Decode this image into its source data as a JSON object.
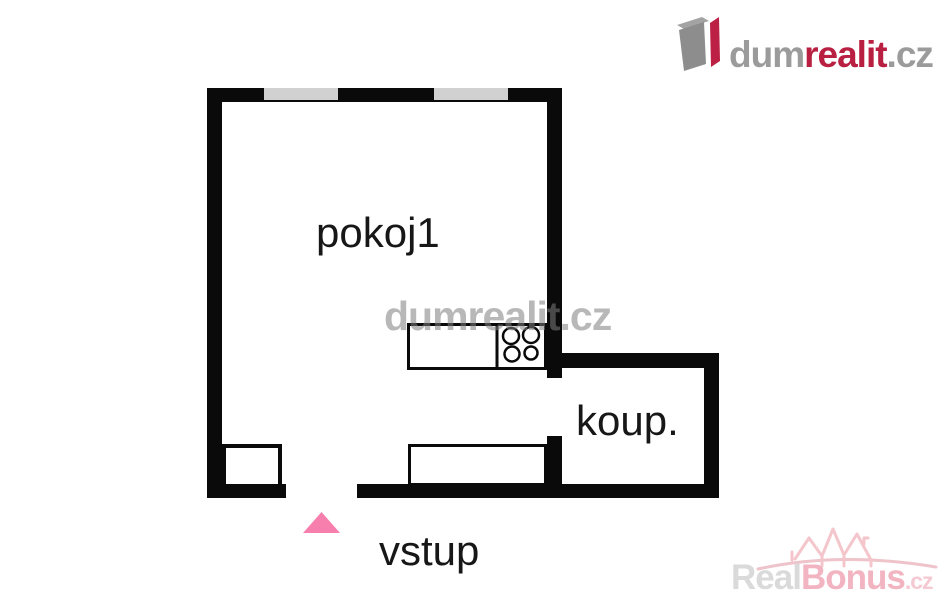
{
  "brand": {
    "icon": "dumrealit-cube-icon",
    "dum": "dum",
    "realit": "realit",
    "cz": ".cz",
    "gray_color": "#9b9b9b",
    "red_color": "#b81f41"
  },
  "floorplan": {
    "room1_label": "pokoj1",
    "bathroom_label": "koup.",
    "entrance_label": "vstup",
    "wall_color": "#0a0a0a",
    "window_color": "#d1d1d1",
    "entrance_arrow_color": "#f77fae",
    "stove_burner_count": 4
  },
  "watermarks": {
    "center_text": "dumrealit.cz",
    "bottom_real": "Real",
    "bottom_bonus": "Bonus",
    "bottom_cz": ".cz",
    "bottom_gray_color": "#dadada",
    "bottom_pink_color": "#f1b4c0"
  }
}
